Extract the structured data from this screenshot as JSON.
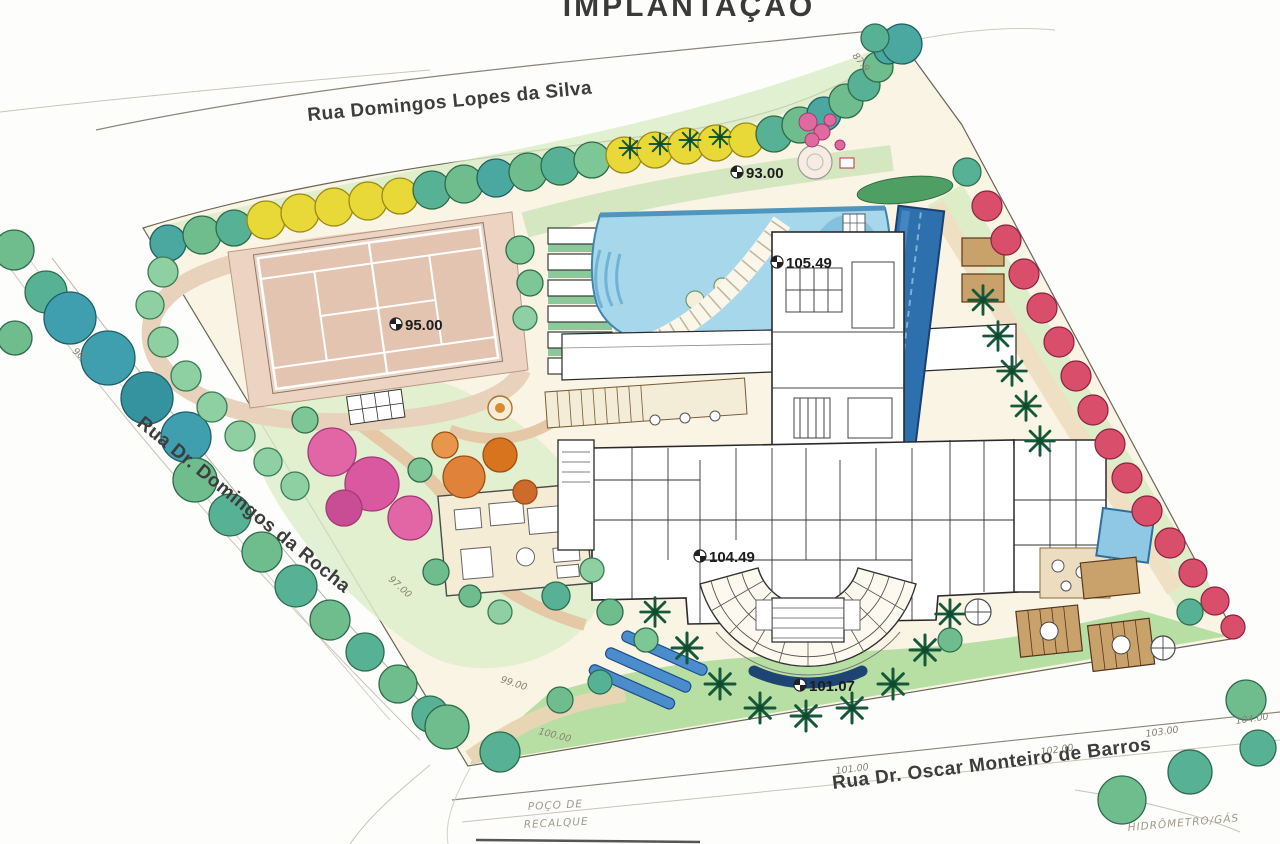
{
  "title": "IMPLANTAÇÃO",
  "streets": {
    "top": "Rua Domingos Lopes da Silva",
    "left": "Rua Dr. Domingos da Rocha",
    "bottom": "Rua Dr. Oscar Monteiro de Barros"
  },
  "benchmarks": {
    "b93": "93.00",
    "b105": "105.49",
    "b95": "95.00",
    "b104": "104.49",
    "b101": "101.07"
  },
  "contours": {
    "c90": "90",
    "c879": "87.9",
    "c97": "97.00",
    "c99": "99.00",
    "c100": "100.00",
    "c101": "101.00",
    "c102": "102.00",
    "c103": "103.00",
    "c104": "104.00"
  },
  "notes": {
    "sump_line1": "POÇO DE",
    "sump_line2": "RECALQUE",
    "meter": "HIDRÔMETRO/GÁS"
  },
  "palette": {
    "paper": "#faf4e4",
    "tree_green": "#6fbd8d",
    "tree_teal": "#3f9fae",
    "pool_blue": "#a6d7ea",
    "lap_pool_blue": "#2e6fae",
    "red_tree": "#d94f6b",
    "yellow_tree": "#e8d838",
    "pink_tree": "#e265a5",
    "court_tan": "#e3c4b0",
    "lawn_green": "#b7dfa4"
  }
}
